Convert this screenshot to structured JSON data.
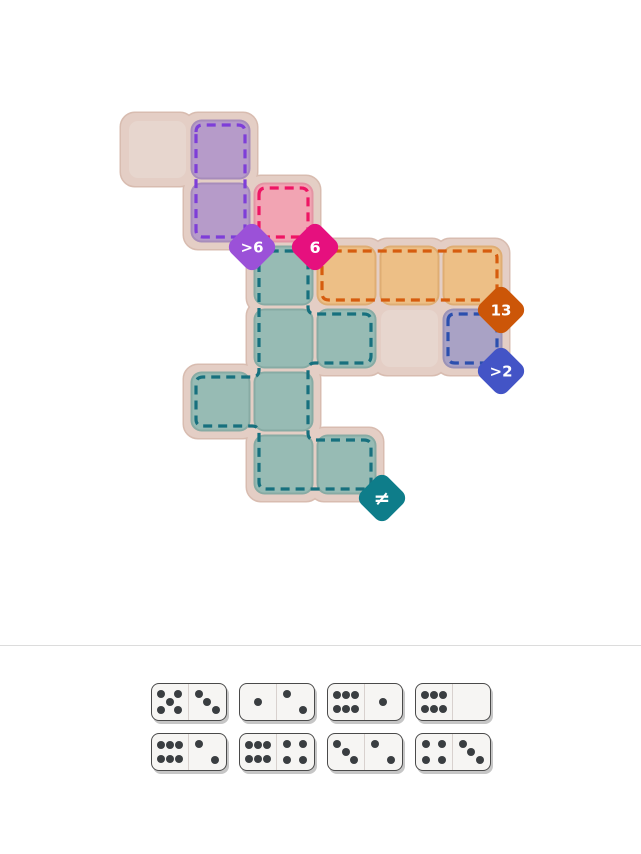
{
  "board": {
    "grid": {
      "origin_x": 126,
      "origin_y": 118,
      "cell_size": 63
    },
    "colors": {
      "base_fill": "#e4cec5",
      "base_border": "#d8bcb0",
      "plain_tile": "#e7d6ce"
    },
    "plain_cells": [
      [
        0,
        0
      ],
      [
        4,
        3
      ]
    ],
    "regions": [
      {
        "name": "purple-region",
        "fill": "#b69bc9",
        "seam": "#a78cbb",
        "dash": "#7e3ed8",
        "cells": [
          [
            1,
            0
          ],
          [
            1,
            1
          ]
        ]
      },
      {
        "name": "pink-region",
        "fill": "#f2a4b3",
        "seam": "#e494a4",
        "dash": "#ee1564",
        "cells": [
          [
            2,
            1
          ]
        ]
      },
      {
        "name": "orange-region",
        "fill": "#edbf86",
        "seam": "#dfad73",
        "dash": "#d65c0e",
        "cells": [
          [
            3,
            2
          ],
          [
            4,
            2
          ],
          [
            5,
            2
          ]
        ]
      },
      {
        "name": "lavender-region",
        "fill": "#a9a2c5",
        "seam": "#9a92b7",
        "dash": "#2b4fae",
        "cells": [
          [
            5,
            3
          ]
        ]
      },
      {
        "name": "teal-region",
        "fill": "#97bbb4",
        "seam": "#87aba4",
        "dash": "#17707e",
        "cells": [
          [
            2,
            2
          ],
          [
            2,
            3
          ],
          [
            3,
            3
          ],
          [
            1,
            4
          ],
          [
            2,
            4
          ],
          [
            2,
            5
          ],
          [
            3,
            5
          ]
        ]
      }
    ],
    "badges": [
      {
        "label": ">6",
        "color": "#9b51d8",
        "x": 252,
        "y": 247,
        "font": 15
      },
      {
        "label": "6",
        "color": "#e6107e",
        "x": 315,
        "y": 247,
        "font": 16
      },
      {
        "label": "13",
        "color": "#cc5608",
        "x": 501,
        "y": 310,
        "font": 15
      },
      {
        "label": ">2",
        "color": "#4354c6",
        "x": 501,
        "y": 371,
        "font": 15
      },
      {
        "label": "≠",
        "color": "#0e7d8a",
        "x": 382,
        "y": 498,
        "font": 20
      }
    ]
  },
  "tray": {
    "rows": [
      [
        {
          "left": 5,
          "right": 3
        },
        {
          "left": 1,
          "right": 2
        },
        {
          "left": 6,
          "right": 1
        },
        {
          "left": 6,
          "right": 0
        }
      ],
      [
        {
          "left": 6,
          "right": 2
        },
        {
          "left": 6,
          "right": 4
        },
        {
          "left": 3,
          "right": 2
        },
        {
          "left": 4,
          "right": 3
        }
      ]
    ]
  }
}
